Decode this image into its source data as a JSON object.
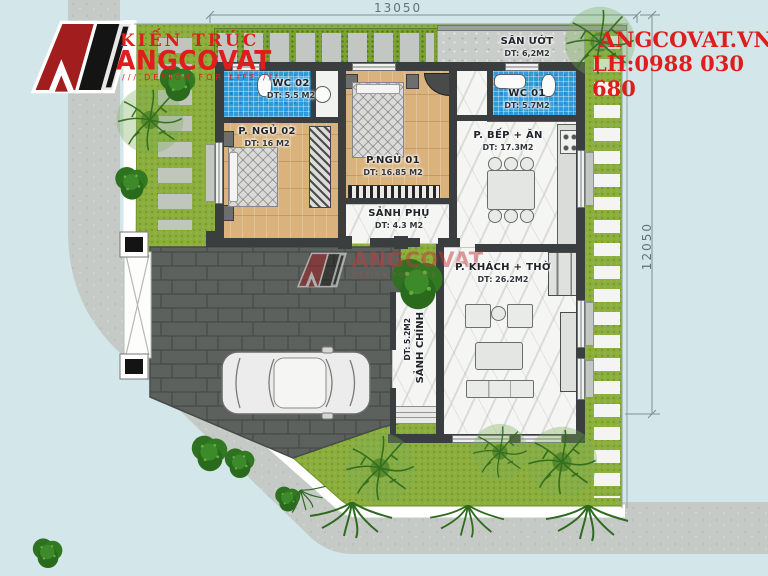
{
  "branding": {
    "logo_top": "KIẾN TRÚC",
    "logo_name": "ANGCOVAT",
    "logo_tagline": "DESIGN FOR LIFE",
    "slashes": "///",
    "website": "ANGCOVAT.VN",
    "hotline": "LH:0988 030 680",
    "accent_red": "#e01d1d"
  },
  "dimensions": {
    "width_label": "13050",
    "height_label": "12050"
  },
  "rooms": {
    "san_uot": {
      "name": "SÂN ƯỚT",
      "area": "DT: 6,2M2"
    },
    "wc02": {
      "name": "WC 02",
      "area": "DT: 5.5 M2"
    },
    "p_ngu_02": {
      "name": "P. NGỦ 02",
      "area": "DT: 16 M2"
    },
    "p_ngu_01": {
      "name": "P.NGỦ 01",
      "area": "DT: 16.85 M2"
    },
    "wc01": {
      "name": "WC 01",
      "area": "DT: 5.7M2"
    },
    "bep_an": {
      "name": "P. BẾP + ĂN",
      "area": "DT: 17.3M2"
    },
    "sanh_phu": {
      "name": "SẢNH PHỤ",
      "area": "DT: 4.3 M2"
    },
    "khach_tho": {
      "name": "P. KHÁCH + THỜ",
      "area": "DT: 26.2M2"
    },
    "sanh_chinh": {
      "name": "SẢNH CHÍNH",
      "area": "DT: 5.2M2"
    }
  },
  "watermark": {
    "name": "ANGCOVAT",
    "tagline": "DESIGN FOR LIFE"
  },
  "colors": {
    "background": "#d3e7ea",
    "lawn": "#8cae3d",
    "courtyard_paving": "#5d615e",
    "sidewalk": "#c6cac6",
    "wc_tile": "#2f9cd9",
    "wood_floor": "#d9b27c",
    "marble_floor": "#f5f5f3",
    "wall": "#3a3e3e"
  }
}
